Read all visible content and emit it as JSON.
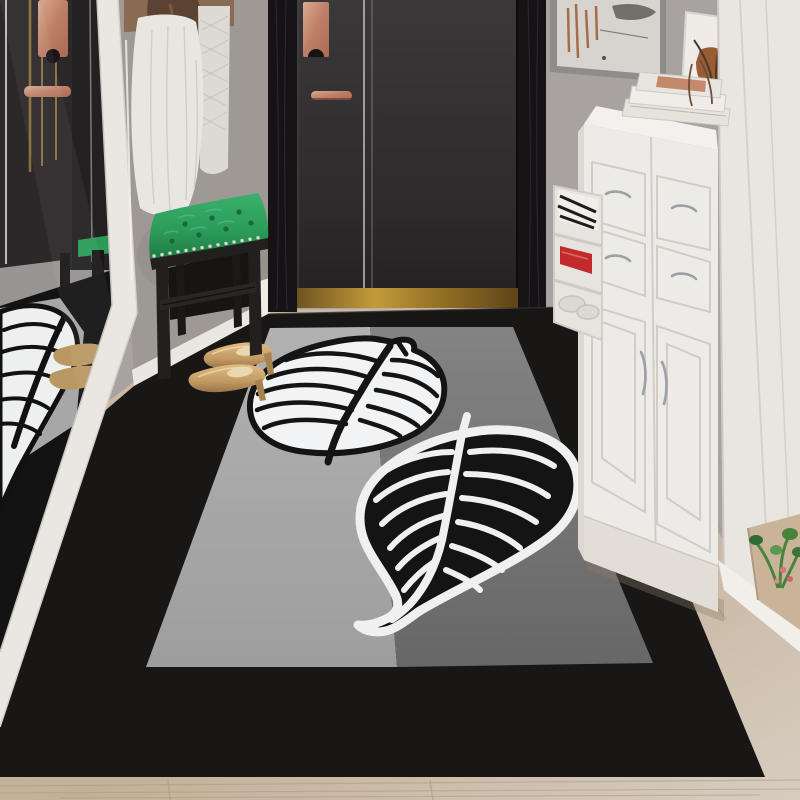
{
  "scene": {
    "description": "Interior product photo: entryway hallway with a large black-bordered area rug; rug interior split into light-gray and mid-gray halves, decorated with a white leaf with black veins and a black leaf with white veins; gold high-heel shoes rest on the rug and are reflected in a leaning white-framed mirror; dark charcoal door with rose-gold hardware; green tufted bench; white shoe cabinet with books and abstract art; light wood floor",
    "objects": [
      "leaning-mirror-with-white-frame",
      "mirror-reflection-of-dark-wardrobe-with-rose-gold-handles",
      "mirror-reflection-of-rug-leaf-and-gold-shoes",
      "white-robe-hanging-on-wall",
      "wood-shelf-with-brown-bag",
      "green-tufted-bench-with-nailhead-trim",
      "charcoal-entry-door-with-rose-gold-plate-and-handle",
      "gold-threshold-strip",
      "black-border-leaf-rug",
      "white-leaf-motif-with-black-veins",
      "black-leaf-motif-with-white-veins",
      "gold-high-heel-shoes",
      "white-shoe-cabinet-with-silver-handles",
      "stacked-books-on-cabinet",
      "gray-framed-abstract-art",
      "small-white-frame-with-rust-figure",
      "side-shelf-with-magazines-and-red-shoes",
      "white-wall-panel",
      "beige-mat-with-small-plant",
      "light-wood-floor"
    ]
  },
  "palette": {
    "wall": "#a8a3a0",
    "wall_left": "#9e9995",
    "door": "#312f30",
    "door_frame": "#161316",
    "rose_gold": "#c08468",
    "threshold_gold": "#b8903a",
    "mirror_frame": "#eae7e2",
    "baseboard": "#eae7e2",
    "rug_border": "#181716",
    "rug_gray_light": "#a9a9a9",
    "rug_gray_mid": "#757474",
    "leaf_white": "#f2f3f4",
    "leaf_black": "#141414",
    "bench_green": "#2b9a58",
    "bench_wood": "#221f1e",
    "robe_white": "#e9e6e2",
    "cabinet_white": "#edebe7",
    "right_panel": "#e9e6e2",
    "floor_light": "#d5cabb",
    "floor_tan": "#c3b098",
    "mat_beige": "#c9b49a",
    "shoes_gold": "#c7a06b",
    "plant_green": "#47833d",
    "art_rust": "#9a5c33",
    "accent_red": "#c22a2e"
  }
}
